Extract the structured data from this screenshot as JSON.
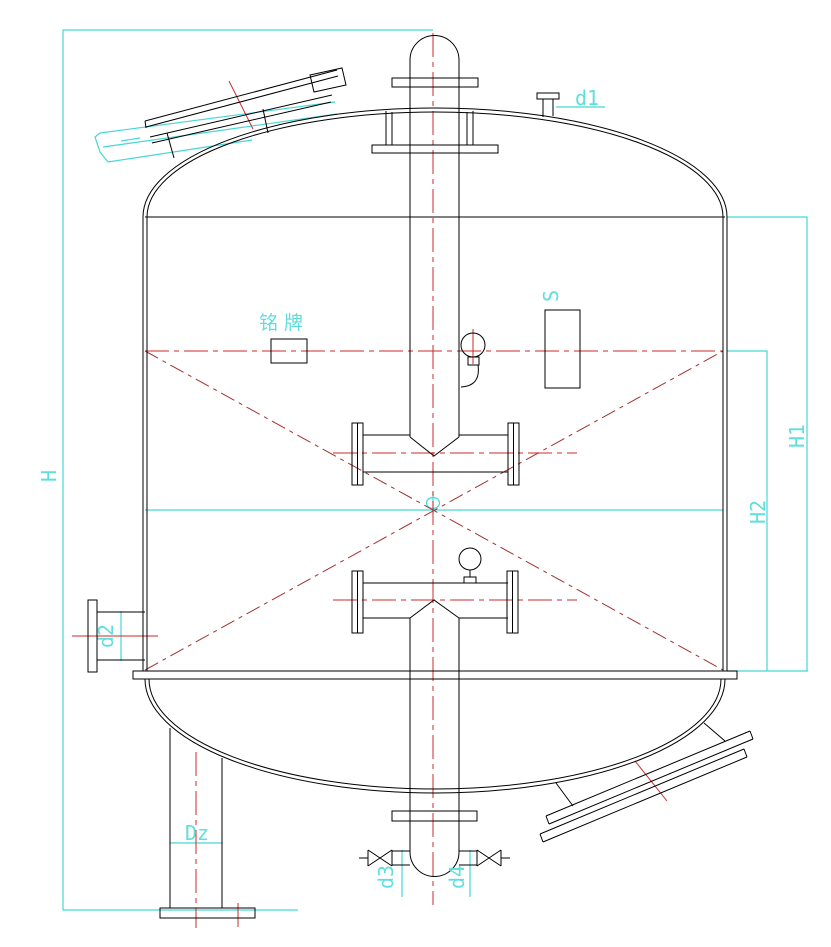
{
  "drawing": {
    "type": "pressure-vessel-elevation",
    "colors": {
      "outline": "#000000",
      "centerline": "#cc2a2a",
      "diagonal": "#a63030",
      "dimension": "#46d7d7",
      "label_text": "#5fdede"
    },
    "labels": {
      "nameplate": "铭牌",
      "sight_glass": "S",
      "nozzle_d1": "d1",
      "nozzle_d2": "d2",
      "nozzle_d3": "d3",
      "nozzle_d4": "d4",
      "dim_total_height": "H",
      "dim_h1": "H1",
      "dim_h2": "H2",
      "dim_leg": "Dz"
    }
  }
}
